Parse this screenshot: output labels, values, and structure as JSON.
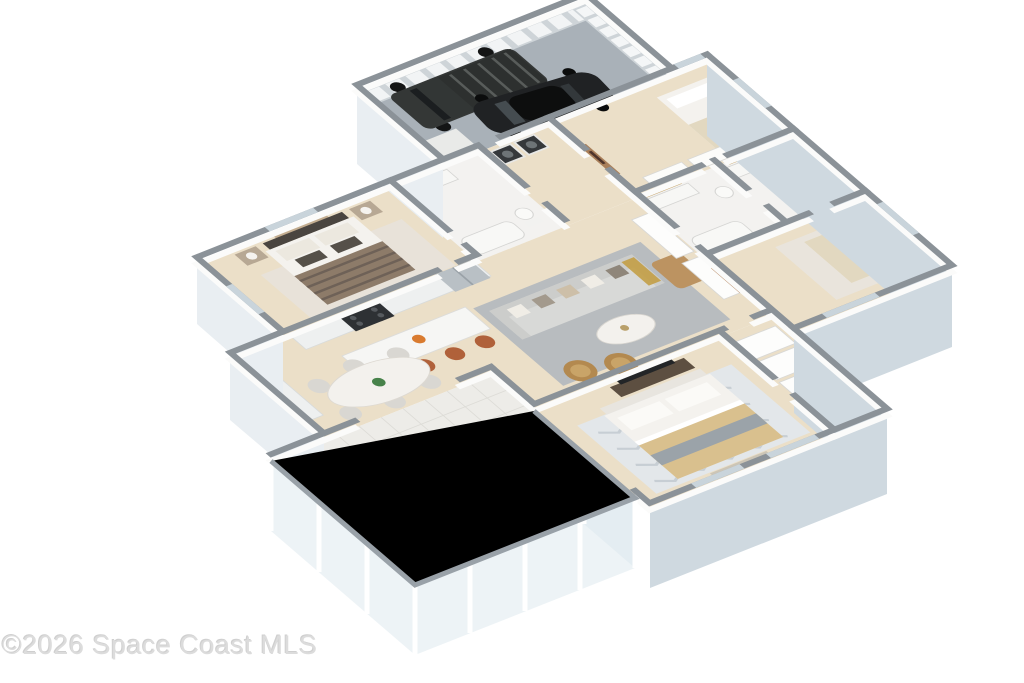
{
  "watermark": {
    "text": "©2026 Space Coast MLS"
  },
  "palette": {
    "background": "#ffffff",
    "floor_wood": "#ebdfc8",
    "floor_tile": "#edece8",
    "tile_grid": "#dddcd7",
    "floor_garage": "#a9b1b8",
    "floor_bath": "#f3f2f0",
    "wall_face": "#fbfbfa",
    "wall_cap": "#8b9298",
    "window_glass": "#c9d4db",
    "exterior_face": "#cfd9e0",
    "exterior_face_light": "#e9eef2",
    "glass": "#dce7ee",
    "sofa": "#d8d9d7",
    "rug_living": "#b8bcbf",
    "rug_master": "#e3e7ea",
    "armchair": "#b3894f",
    "stool": "#b0613a",
    "ottoman": "#bc9361",
    "counter": "#eef0f0",
    "island": "#f6f6f4",
    "appliance_dark": "#2e3134",
    "fridge": "#b9c0c5",
    "dining_chair": "#d9d7d2",
    "table_top": "#f3f1ed",
    "sunroom_table": "#ded5c6",
    "bed_white": "#f4f2ee",
    "blanket_bed2": "#8d7b69",
    "blanket_master_tan": "#d9c08e",
    "blanket_master_gray": "#9ba3a9",
    "blanket_bed4": "#e2d8c0",
    "headboard_dark": "#4a4540",
    "tv_console_wood": "#5d4f41",
    "tv_screen": "#232527",
    "truck_body": "#343736",
    "sedan_body": "#202224",
    "plant_green": "#47824a",
    "watermark_color": "#dcdcdc"
  }
}
